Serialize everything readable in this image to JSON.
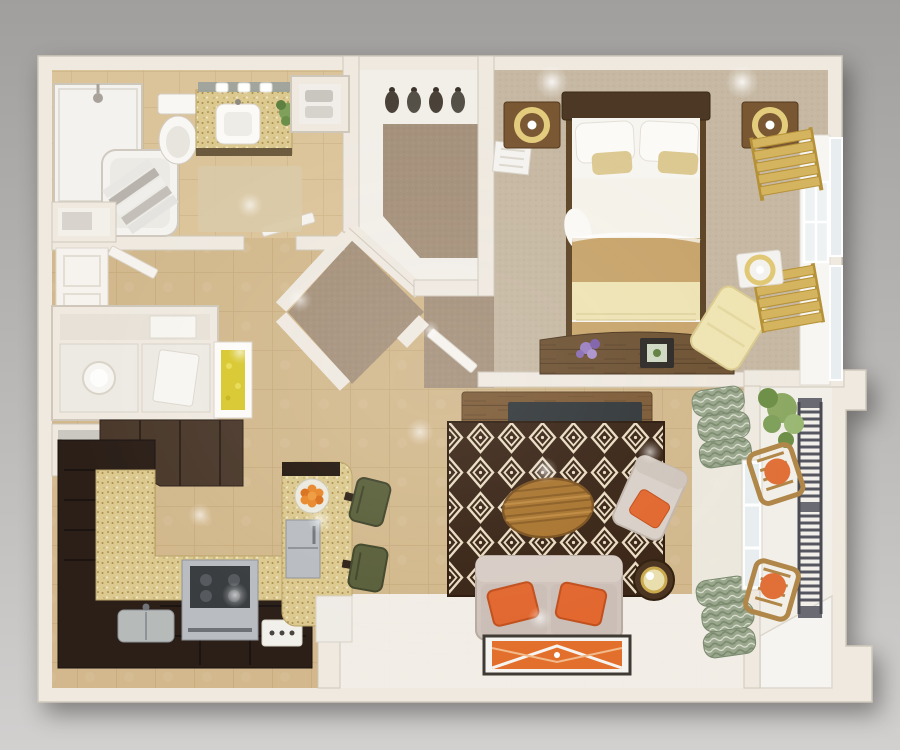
{
  "scene": {
    "type": "3d-floor-plan-top-view",
    "title": "One-bedroom apartment 3D floor plan render",
    "style": "photorealistic dollhouse top view, no text labels"
  },
  "palette": {
    "bg_top": "#a19f9d",
    "bg_bottom": "#d2d0cf",
    "wall": "#efe9e0",
    "wall_edge": "#cfc8ba",
    "tile": "#d2b88c",
    "tile_line": "#c3a878",
    "bath_tile": "#dcc49a",
    "bath_tile_line": "#ccb184",
    "white_floor": "#f2efe9",
    "carpet_bedroom": "#c6b8a2",
    "carpet_hall": "#a5917b",
    "rug_base": "#3a2516",
    "rug_accent": "#e9dcc2",
    "cabinet_dark": "#2b1f18",
    "cabinet_upper": "#4a392b",
    "counter_speckle": "#dcc98f",
    "steel": "#b9bdc1",
    "steel_dark": "#3a3d40",
    "rustic_wood": "#7c5a36",
    "rustic_wood_dark": "#5d4326",
    "table_wood": "#a9752f",
    "table_wood_dark": "#7c5220",
    "bed_frame": "#4c3824",
    "linen_white": "#f7f5f0",
    "blanket_tan": "#c7a46b",
    "throw_cream": "#eee3b4",
    "accent_pillow_tan": "#dcc992",
    "nightstand_wood": "#7a5733",
    "lamp_gold": "#e3cc7c",
    "sofa_beige": "#cfc3bb",
    "sofa_beige_dark": "#b8aba2",
    "pillow_orange": "#e2672f",
    "pillow_orange_dark": "#c24f1d",
    "blind_gold": "#d4b45e",
    "blind_gold_dark": "#b59138",
    "curtain_green": "#9aa78c",
    "curtain_green_dark": "#7a8a6e",
    "plant_green": "#7fa05a",
    "plant_green_dark": "#5e8040",
    "railing_gray": "#565660",
    "glass_blue": "#e8eef0",
    "window_white": "#fdfdfc",
    "art_yellow": "#d8c830",
    "art_orange": "#e2702c",
    "flower_purple": "#9a7fc0",
    "stool_olive": "#5a5f3a",
    "vanity_granite": "#d9c488",
    "bath_mat": "#d9c9a6",
    "chair_cream": "#efe4b2",
    "balcony_wood": "#b08748"
  },
  "rooms": [
    {
      "id": "bathroom",
      "label": "Bathroom",
      "items": [
        "walk-in shower",
        "bathtub with striped towels",
        "toilet",
        "granite vanity with sink",
        "mirror with three vanity lights",
        "potted plant",
        "bath mat",
        "storage niche",
        "linen cabinet",
        "open door"
      ]
    },
    {
      "id": "walk-in-closet",
      "label": "Walk-in Closet",
      "items": [
        "clothes hangers",
        "area carpet"
      ]
    },
    {
      "id": "bedroom",
      "label": "Bedroom",
      "items": [
        "double bed with tan blanket",
        "dark wood headboard",
        "two nightstands",
        "two gold ring lamps",
        "two gold roman blinds",
        "windows",
        "wall reading lamp",
        "cream lounge chair",
        "rustic storage bench",
        "purple flowers",
        "photo frame",
        "air vent",
        "open door"
      ]
    },
    {
      "id": "entry-hall",
      "label": "Entry Hall",
      "items": [
        "front door",
        "open door leaf",
        "console shelving unit",
        "round lamp",
        "yellow framed artwork",
        "gray side cabinet",
        "diagonal carpeted vestibule"
      ]
    },
    {
      "id": "kitchen",
      "label": "Kitchen",
      "items": [
        "L-shaped dark cabinets",
        "upper cabinets",
        "speckled granite bar counter",
        "stainless stove",
        "stainless sink",
        "peninsula island with fridge",
        "fruit bowl with oranges",
        "two olive bar stools",
        "switch plate",
        "half wall"
      ]
    },
    {
      "id": "living-room",
      "label": "Living Room",
      "items": [
        "media console with TV",
        "diamond pattern rug",
        "oval wood coffee table",
        "beige loveseat sofa",
        "two orange throw pillows",
        "accent armchair with orange pillow",
        "round side table with lamp",
        "framed orange floor art",
        "green patterned curtains",
        "window to balcony"
      ]
    },
    {
      "id": "balcony",
      "label": "Balcony",
      "items": [
        "slatted metal railing",
        "two wooden chairs with orange cushions",
        "hanging plant",
        "corner ledge"
      ]
    }
  ]
}
